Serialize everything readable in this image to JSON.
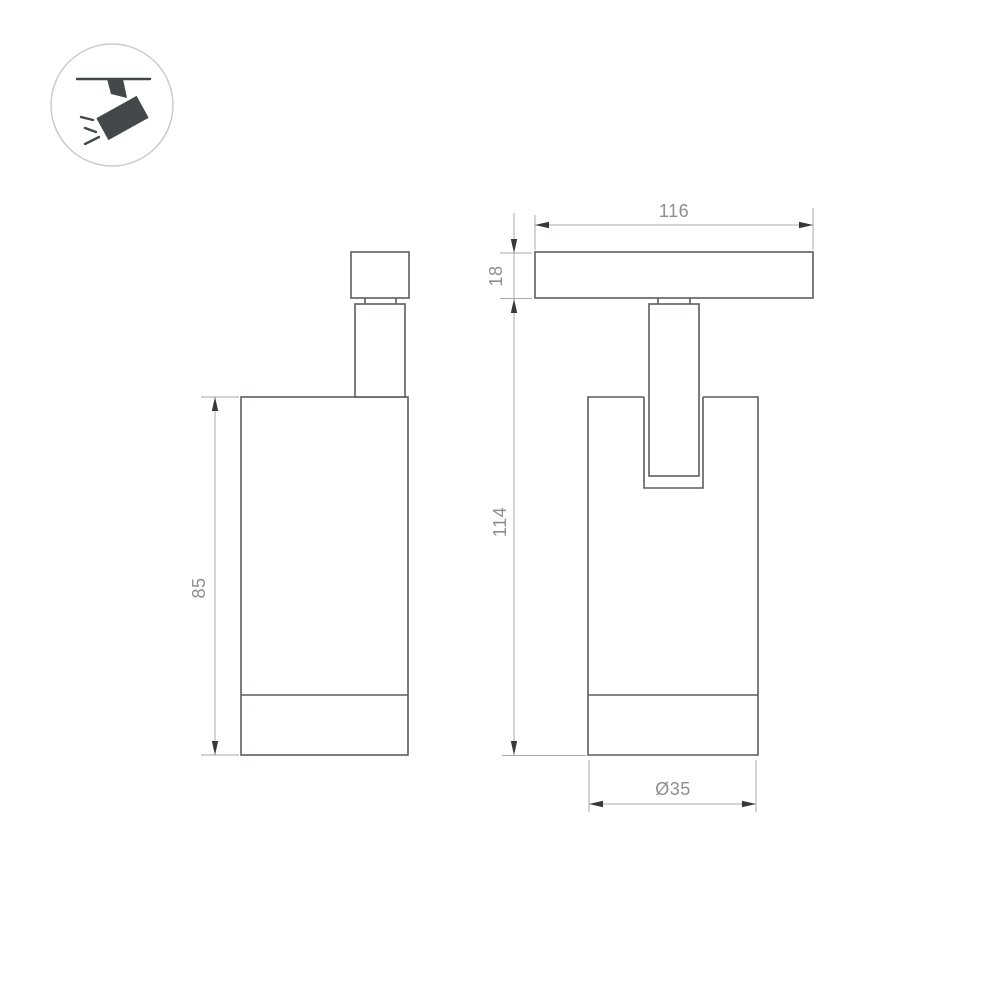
{
  "drawing": {
    "type": "technical-dimension-drawing",
    "subject": "magnetic track spotlight, side and front orthographic views",
    "icon": "ceiling-track-spotlight",
    "dimensions": {
      "body_height_side": "85",
      "track_adapter_width": "116",
      "track_adapter_height": "18",
      "overall_height": "114",
      "body_diameter": "Ø35"
    },
    "colors": {
      "background": "#ffffff",
      "object_outline": "#5a5e61",
      "dimension_lines": "#a6aaac",
      "arrowheads": "#35393c",
      "dimension_text": "#8b8f92",
      "icon_fill": "#43484b",
      "icon_ring": "#c9cccf"
    }
  }
}
